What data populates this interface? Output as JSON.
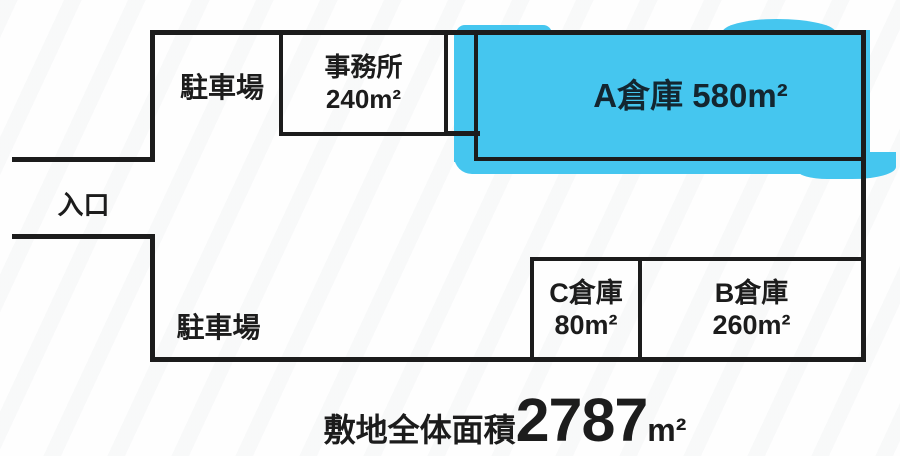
{
  "colors": {
    "line": "#1c1c1c",
    "text": "#1c1c1c",
    "highlight": "#45c6ef",
    "highlight-text": "#132630"
  },
  "site_plan": {
    "entrance": {
      "label": "入口"
    },
    "parking_north": {
      "label": "駐車場"
    },
    "parking_south": {
      "label": "駐車場"
    },
    "rooms": {
      "office": {
        "name": "事務所",
        "area": "240m²"
      },
      "warehouse_a": {
        "label": "A倉庫 580m²"
      },
      "warehouse_c": {
        "name": "C倉庫",
        "area": "80m²"
      },
      "warehouse_b": {
        "name": "B倉庫",
        "area": "260m²"
      }
    },
    "total_area": {
      "label": "敷地全体面積",
      "value": "2787",
      "unit": "m²"
    }
  }
}
